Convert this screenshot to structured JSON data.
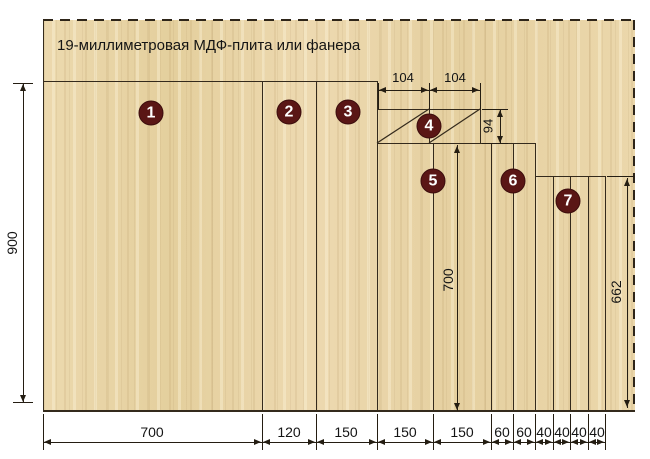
{
  "title": "19-миллиметровая МДФ-плита или фанера",
  "colors": {
    "wood_base": "#e9d5a7",
    "cut_line": "#342a1c",
    "badge_fill": "#5a1615",
    "badge_text": "#ffffff",
    "dimension_line": "#241d12"
  },
  "badges": {
    "b1": "1",
    "b2": "2",
    "b3": "3",
    "b4": "4",
    "b5": "5",
    "b6": "6",
    "b7": "7"
  },
  "dims": {
    "total_height": "900",
    "w_700": "700",
    "w_120": "120",
    "w_150a": "150",
    "w_150b": "150",
    "w_150c": "150",
    "w_60a": "60",
    "w_60b": "60",
    "w_40a": "40",
    "w_40b": "40",
    "w_40c": "40",
    "w_40d": "40",
    "top_104a": "104",
    "top_104b": "104",
    "h_94": "94",
    "h_700": "700",
    "h_662": "662"
  }
}
